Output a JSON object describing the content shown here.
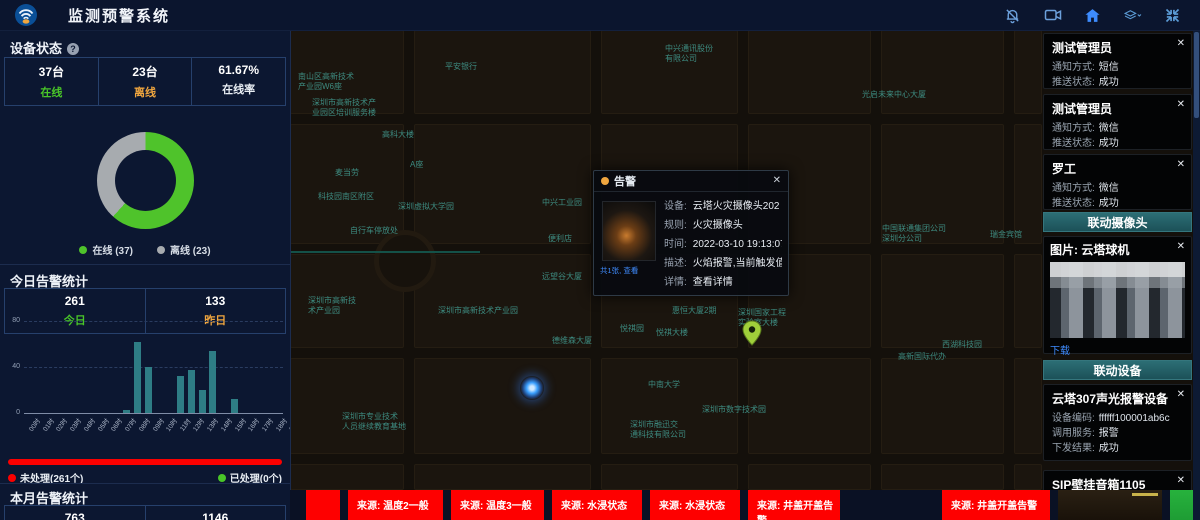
{
  "header": {
    "title": "监测预警系统",
    "icons": [
      "bell-off-icon",
      "video-camera-icon",
      "home-icon",
      "layers-icon",
      "fullscreen-icon"
    ]
  },
  "ui": {
    "close": "✕",
    "help": "?"
  },
  "device_status": {
    "title": "设备状态",
    "stats": [
      {
        "value": "37台",
        "label": "在线",
        "color": "green"
      },
      {
        "value": "23台",
        "label": "离线",
        "color": "orange"
      },
      {
        "value": "61.67%",
        "label": "在线率",
        "color": "white"
      }
    ],
    "legend": [
      {
        "label": "在线 (37)",
        "color": "#4fc32b"
      },
      {
        "label": "离线 (23)",
        "color": "#a7abaf"
      }
    ]
  },
  "today_alarms": {
    "title": "今日告警统计",
    "stats": [
      {
        "value": "261",
        "label": "今日",
        "color": "green"
      },
      {
        "value": "133",
        "label": "昨日",
        "color": "orange"
      }
    ],
    "unprocessed_label": "未处理(261个)",
    "processed_label": "已处理(0个)"
  },
  "month_alarms": {
    "title": "本月告警统计",
    "stats": [
      {
        "value": "763",
        "label": "",
        "color": "white"
      },
      {
        "value": "1146",
        "label": "",
        "color": "white"
      }
    ]
  },
  "chart_data": [
    {
      "type": "pie",
      "title": "设备状态",
      "labels": [
        "在线",
        "离线"
      ],
      "values": [
        37,
        23
      ],
      "colors": [
        "#4fc32b",
        "#a7abaf"
      ],
      "donut": true,
      "online_rate": "61.67%"
    },
    {
      "type": "bar",
      "title": "今日告警统计(按小时)",
      "categories": [
        "00时",
        "01时",
        "02时",
        "03时",
        "04时",
        "05时",
        "06时",
        "07时",
        "08时",
        "09时",
        "10时",
        "11时",
        "12时",
        "13时",
        "14时",
        "15时",
        "16时",
        "17时",
        "18时",
        "19时",
        "20时",
        "21时",
        "22时",
        "23时"
      ],
      "values": [
        0,
        0,
        0,
        0,
        0,
        0,
        0,
        0,
        0,
        3,
        62,
        40,
        0,
        0,
        32,
        37,
        20,
        54,
        0,
        12,
        0,
        0,
        0,
        0
      ],
      "ylim": [
        0,
        80
      ],
      "yticks": [
        0,
        40,
        80
      ],
      "bar_color": "#2e7d85",
      "grid": true
    }
  ],
  "map": {
    "labels": [
      {
        "text": "中兴通讯股份\n有限公司",
        "x": 375,
        "y": 14
      },
      {
        "text": "平安银行",
        "x": 155,
        "y": 32
      },
      {
        "text": "南山区高新技术\n产业园W6座",
        "x": 8,
        "y": 42
      },
      {
        "text": "深圳市高新技术产\n业园区培训服务楼",
        "x": 22,
        "y": 68
      },
      {
        "text": "光启未来中心大厦",
        "x": 572,
        "y": 60
      },
      {
        "text": "高科大楼",
        "x": 92,
        "y": 100
      },
      {
        "text": "麦当劳",
        "x": 45,
        "y": 138
      },
      {
        "text": "A座",
        "x": 120,
        "y": 130
      },
      {
        "text": "科技园南区附区",
        "x": 28,
        "y": 162
      },
      {
        "text": "深圳虚拟大学园",
        "x": 108,
        "y": 172
      },
      {
        "text": "中兴工业园",
        "x": 252,
        "y": 168
      },
      {
        "text": "中国联通集团公司\n深圳分公司",
        "x": 592,
        "y": 194
      },
      {
        "text": "瑞金宾馆",
        "x": 700,
        "y": 200
      },
      {
        "text": "自行车停放处",
        "x": 60,
        "y": 196
      },
      {
        "text": "便利店",
        "x": 258,
        "y": 204
      },
      {
        "text": "远望谷大厦",
        "x": 252,
        "y": 242
      },
      {
        "text": "深圳市高新技\n术产业园",
        "x": 18,
        "y": 266
      },
      {
        "text": "深圳市高新技术产业园",
        "x": 148,
        "y": 276
      },
      {
        "text": "惠恒大厦2期",
        "x": 382,
        "y": 276
      },
      {
        "text": "悦祺园",
        "x": 330,
        "y": 294
      },
      {
        "text": "悦祺大楼",
        "x": 366,
        "y": 298
      },
      {
        "text": "深圳国家工程\n实验室大楼",
        "x": 448,
        "y": 278
      },
      {
        "text": "西湖科技园",
        "x": 652,
        "y": 310
      },
      {
        "text": "德维森大厦",
        "x": 262,
        "y": 306
      },
      {
        "text": "高新国际代办",
        "x": 608,
        "y": 322
      },
      {
        "text": "中南大学",
        "x": 358,
        "y": 350
      },
      {
        "text": "深圳市数字技术园",
        "x": 412,
        "y": 375
      },
      {
        "text": "深圳市融迅交\n通科技有限公司",
        "x": 340,
        "y": 390
      },
      {
        "text": "深圳市专业技术\n人员继续教育基地",
        "x": 52,
        "y": 382
      }
    ]
  },
  "popup": {
    "title": "告警",
    "thumb_caption": "共1张, 查看",
    "rows": [
      {
        "label": "设备:",
        "value": "云塔火灾摄像头202"
      },
      {
        "label": "规则:",
        "value": "火灾摄像头"
      },
      {
        "label": "时间:",
        "value": "2022-03-10 19:13:07"
      },
      {
        "label": "描述:",
        "value": "火焰报警,当前触发值为..."
      },
      {
        "label": "详情:",
        "value": "查看详情",
        "link": true
      }
    ]
  },
  "notifications": {
    "method_label": "通知方式:",
    "status_label": "推送状态:",
    "cards": [
      {
        "name": "测试管理员",
        "method": "短信",
        "status": "成功"
      },
      {
        "name": "测试管理员",
        "method": "微信",
        "status": "成功"
      },
      {
        "name": "罗工",
        "method": "微信",
        "status": "成功"
      }
    ]
  },
  "linked_camera": {
    "header": "联动摄像头",
    "card_title": "图片: 云塔球机",
    "download_label": "下载"
  },
  "linked_devices": {
    "header": "联动设备",
    "cards": [
      {
        "name": "云塔307声光报警设备",
        "rows": [
          {
            "label": "设备编码:",
            "value": "ffffff100001ab6c"
          },
          {
            "label": "调用服务:",
            "value": "报警"
          },
          {
            "label": "下发结果:",
            "value": "成功",
            "ok": true
          }
        ]
      },
      {
        "name": "SIP壁挂音箱1105",
        "rows": [
          {
            "label": "设备编码:",
            "value": "1105"
          }
        ]
      }
    ]
  },
  "ticker": {
    "items": [
      {
        "type": "red",
        "text": "",
        "width": 34
      },
      {
        "type": "red",
        "text": "来源: 温度2一般",
        "width": 95
      },
      {
        "type": "red",
        "text": "来源: 温度3一般",
        "width": 93
      },
      {
        "type": "red",
        "text": "来源: 水浸状态",
        "width": 90
      },
      {
        "type": "red",
        "text": "来源: 水浸状态",
        "width": 90
      },
      {
        "type": "red",
        "text": "来源: 井盖开盖告警",
        "width": 92
      },
      {
        "type": "gap",
        "width": 86
      },
      {
        "type": "red",
        "text": "来源: 井盖开盖告警",
        "width": 108
      },
      {
        "type": "thumb_dark",
        "width": 104
      },
      {
        "type": "thumb_green",
        "width": 58
      }
    ]
  }
}
